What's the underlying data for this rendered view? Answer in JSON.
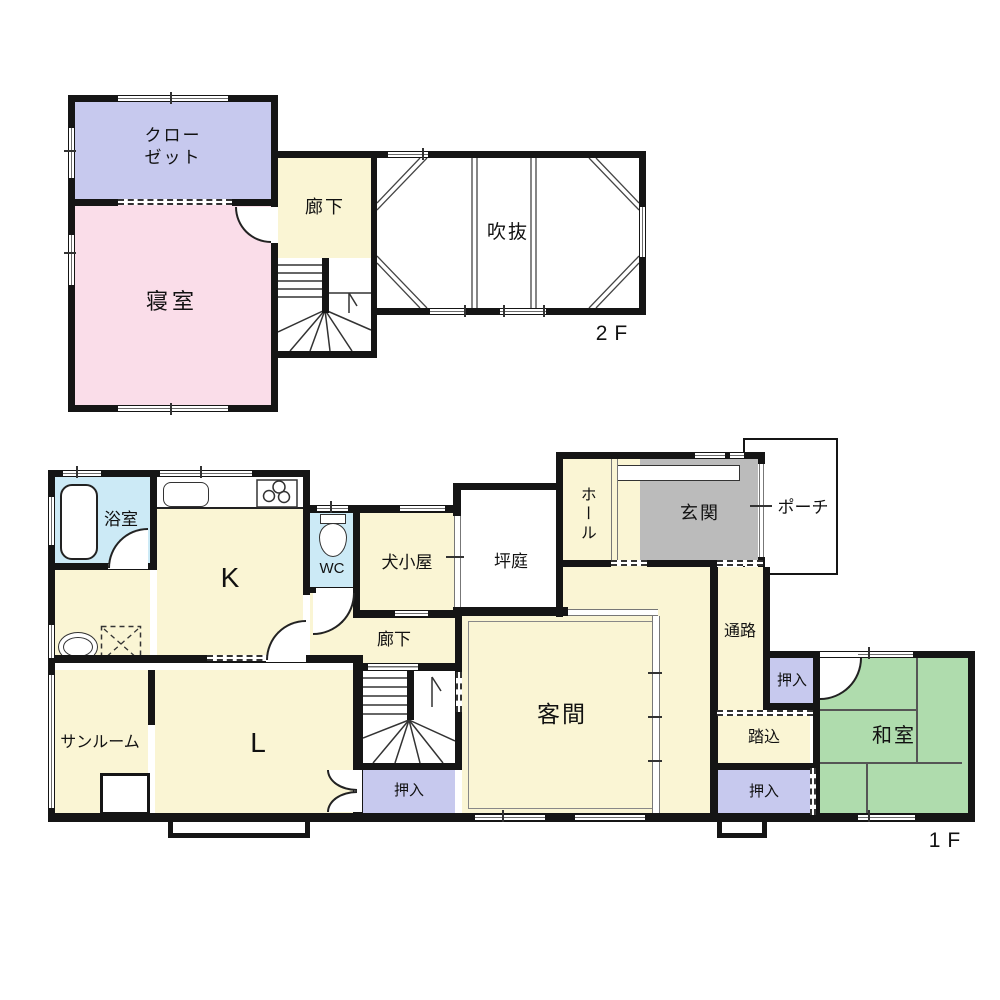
{
  "title": "2-story house floor plan",
  "colors": {
    "wall": "#151515",
    "yellow": "#FAF5D4",
    "pink": "#FADDE9",
    "lavender": "#C7C9EE",
    "blue": "#CCEAF6",
    "green": "#AFDCAD",
    "gray": "#BBBBBB"
  },
  "floor2": {
    "label": "2F",
    "closet_line1": "クロー",
    "closet_line2": "ゼット",
    "bedroom": "寝室",
    "hallway": "廊下",
    "void": "吹抜"
  },
  "floor1": {
    "label": "1F",
    "bathroom": "浴室",
    "kitchen": "K",
    "wc": "WC",
    "doghouse": "犬小屋",
    "courtyard": "坪庭",
    "hall": "ホール",
    "entrance": "玄関",
    "porch": "ポーチ",
    "passage": "通路",
    "closet1": "押入",
    "step_in": "踏込",
    "closet2": "押入",
    "japanese_room": "和室",
    "guest_room": "客間",
    "hallway": "廊下",
    "sunroom": "サンルーム",
    "living": "L",
    "closet3": "押入"
  }
}
